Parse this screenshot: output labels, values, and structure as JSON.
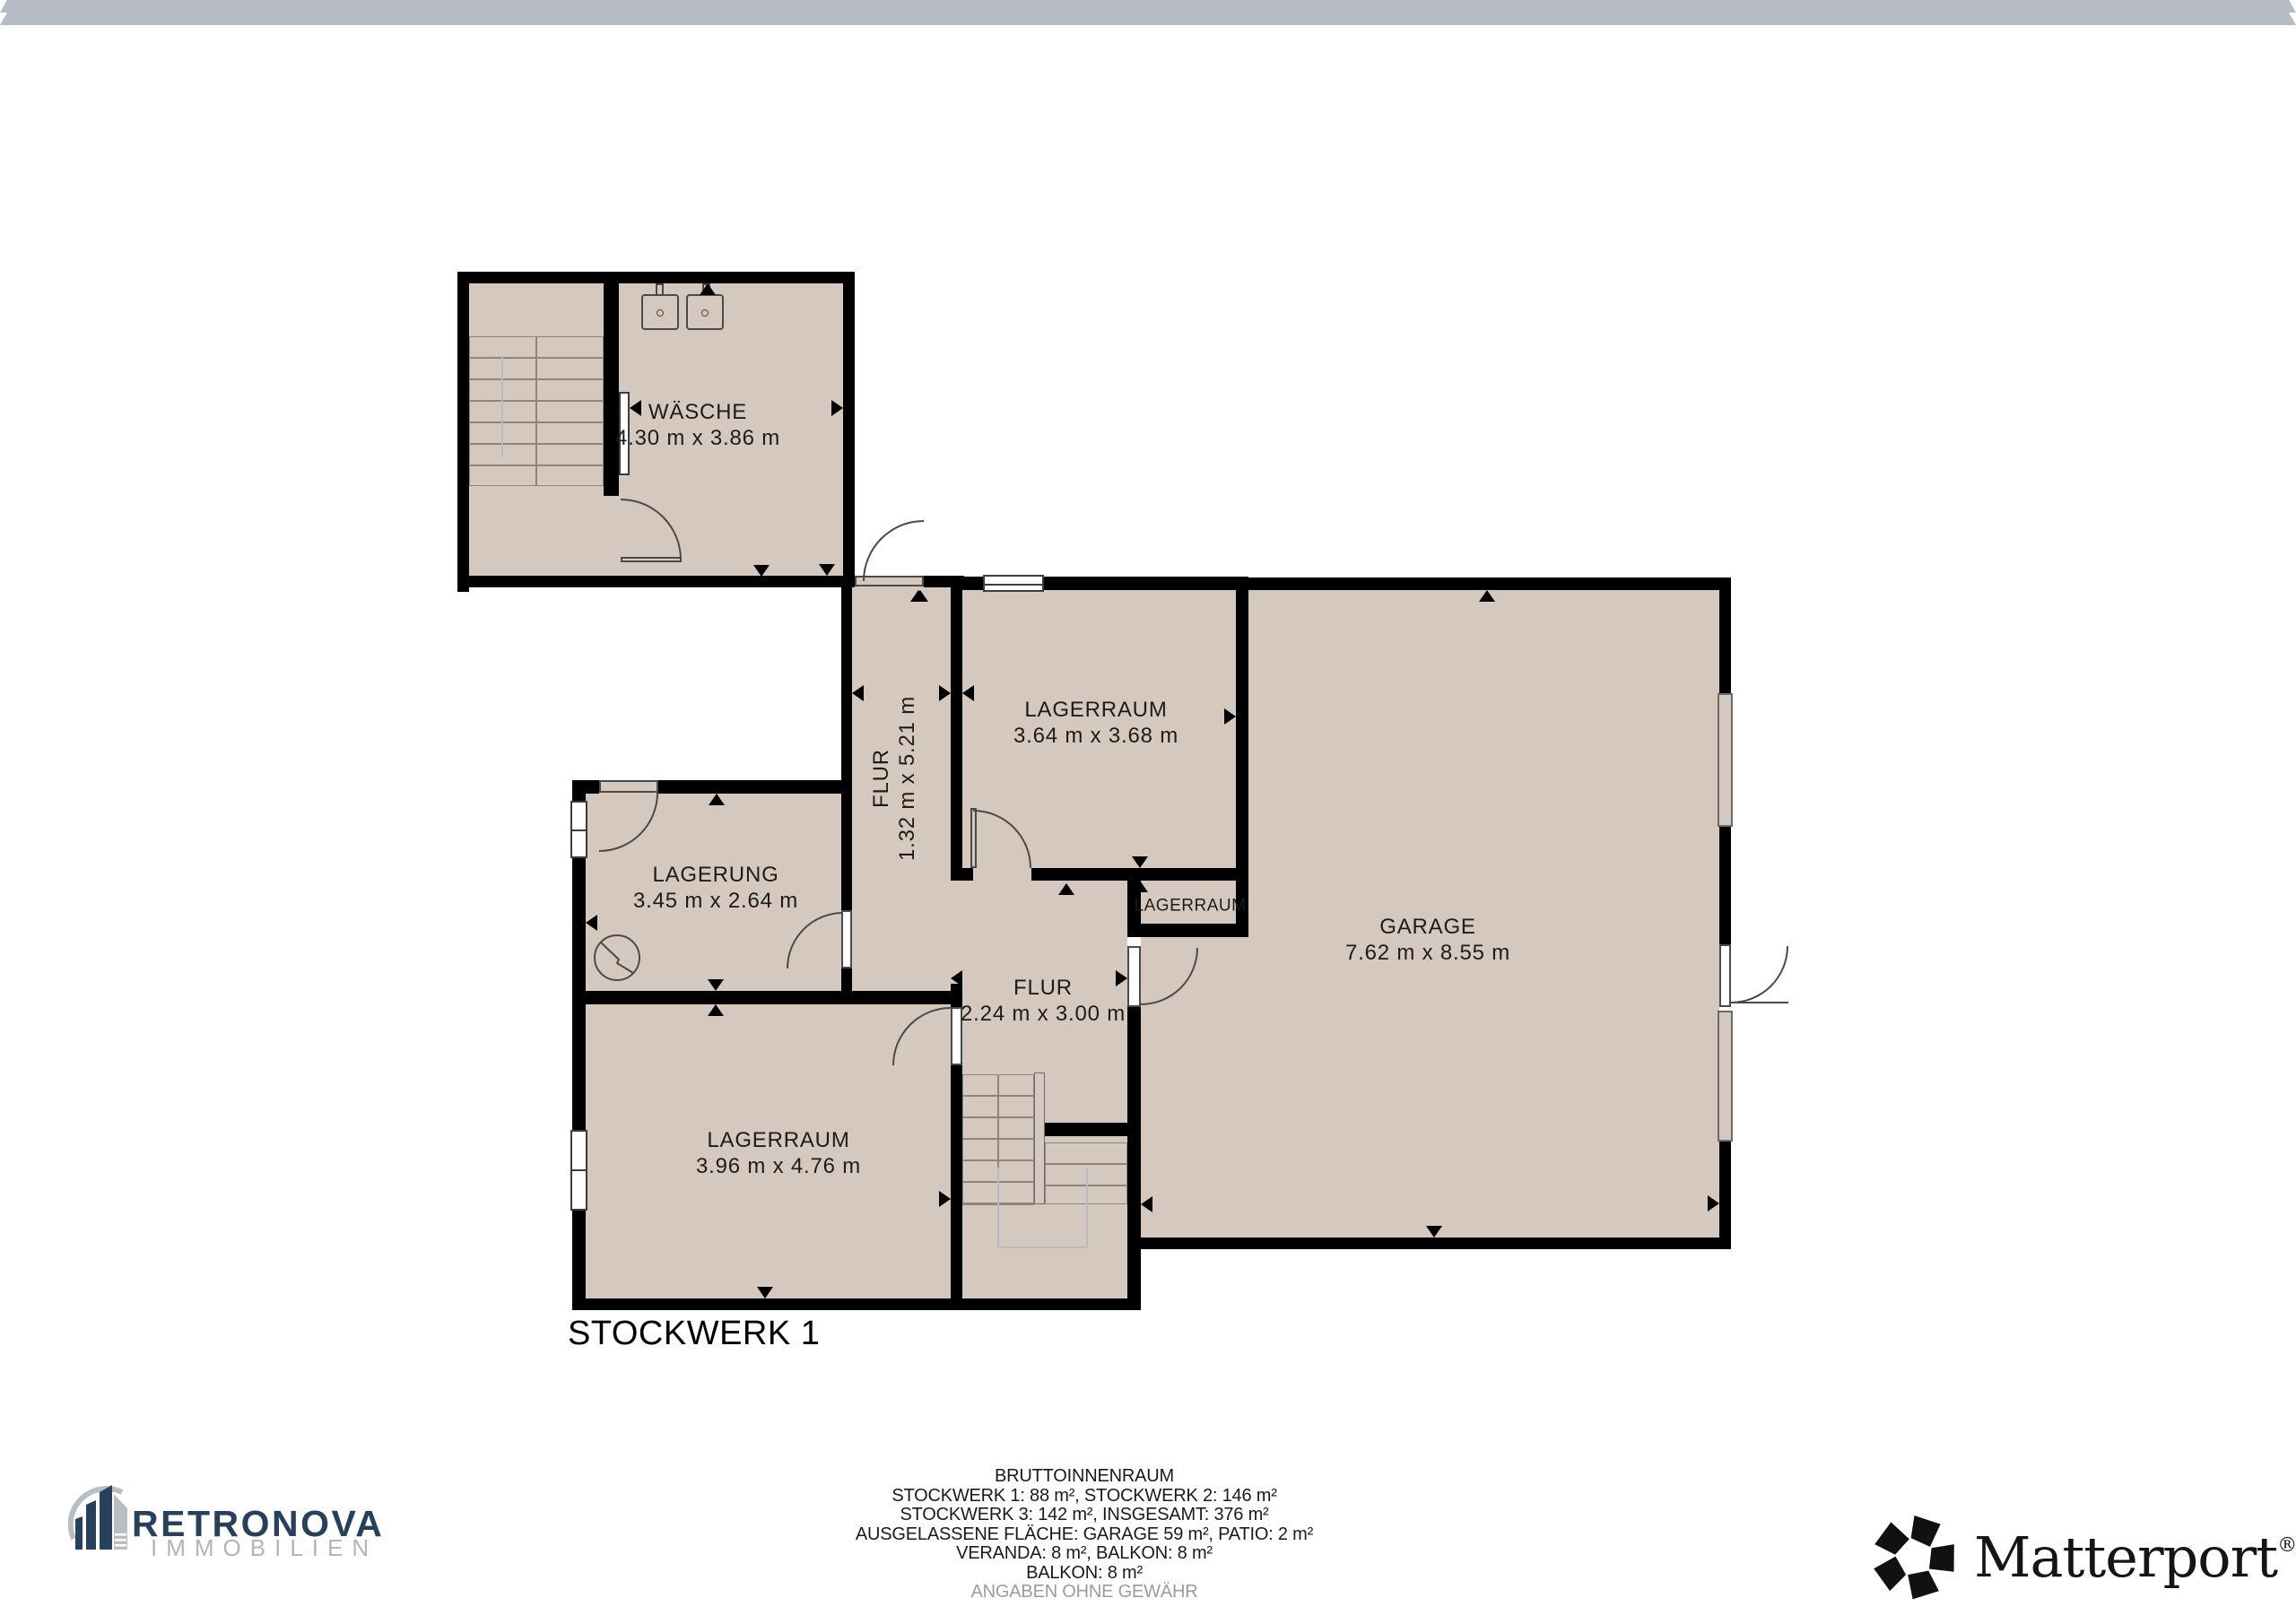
{
  "floor": {
    "label": "STOCKWERK 1"
  },
  "rooms": [
    {
      "id": "waesche",
      "name": "WÄSCHE",
      "dims": "4.30 m x 3.86 m"
    },
    {
      "id": "lagerraum-top",
      "name": "LAGERRAUM",
      "dims": "3.64 m x 3.68 m"
    },
    {
      "id": "flur-corridor",
      "name": "FLUR",
      "dims": "1.32 m x 5.21 m"
    },
    {
      "id": "garage",
      "name": "GARAGE",
      "dims": "7.62 m x 8.55 m"
    },
    {
      "id": "lagerung",
      "name": "LAGERUNG",
      "dims": "3.45 m x 2.64 m"
    },
    {
      "id": "lagerraum-closet",
      "name": "LAGERRAUM",
      "dims": ""
    },
    {
      "id": "flur-room",
      "name": "FLUR",
      "dims": "2.24 m x 3.00 m"
    },
    {
      "id": "lagerraum-lower",
      "name": "LAGERRAUM",
      "dims": "3.96 m x 4.76 m"
    }
  ],
  "summary": {
    "lines": [
      "BRUTTOINNENRAUM",
      "STOCKWERK 1: 88 m², STOCKWERK 2: 146 m²",
      "STOCKWERK 3: 142 m², INSGESAMT: 376 m²",
      "AUSGELASSENE FLÄCHE: GARAGE 59 m², PATIO: 2 m²",
      "VERANDA: 8 m², BALKON: 8 m²",
      "BALKON: 8 m²",
      "ANGABEN OHNE GEWÄHR"
    ]
  },
  "branding": {
    "agency": {
      "name": "RETRONOVA",
      "subtitle": "IMMOBILIEN",
      "accent": "#27415d",
      "muted": "#b0b5ba"
    },
    "provider": {
      "name": "Matterport",
      "registered": "®"
    }
  },
  "colors": {
    "floor": "#d5c9bf",
    "wall": "#000000"
  }
}
